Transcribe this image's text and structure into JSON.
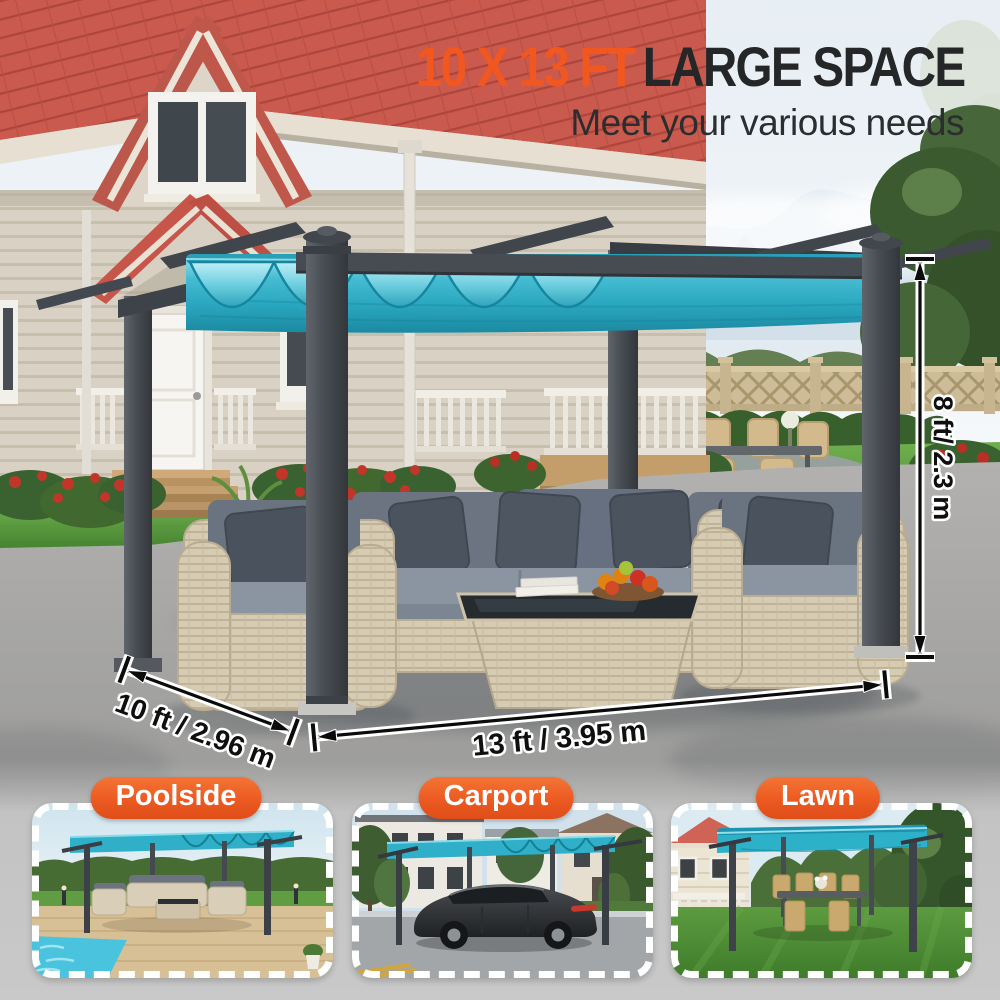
{
  "header": {
    "headline_highlight": "10 X 13 FT",
    "headline_rest": "LARGE SPACE",
    "subtitle": "Meet your various needs"
  },
  "dimensions": {
    "height_label": "8 ft/ 2.3 m",
    "depth_label": "10 ft / 2.96 m",
    "width_label": "13 ft / 3.95 m"
  },
  "scenes": [
    {
      "label": "Poolside"
    },
    {
      "label": "Carport"
    },
    {
      "label": "Lawn"
    }
  ],
  "colors": {
    "accent_orange": "#EC5A22",
    "headline_orange": "#F1571E",
    "headline_dark": "#242628",
    "canopy_teal": "#2FB0C8",
    "frame_gray": "#43484D",
    "roof_red": "#C7554A"
  }
}
